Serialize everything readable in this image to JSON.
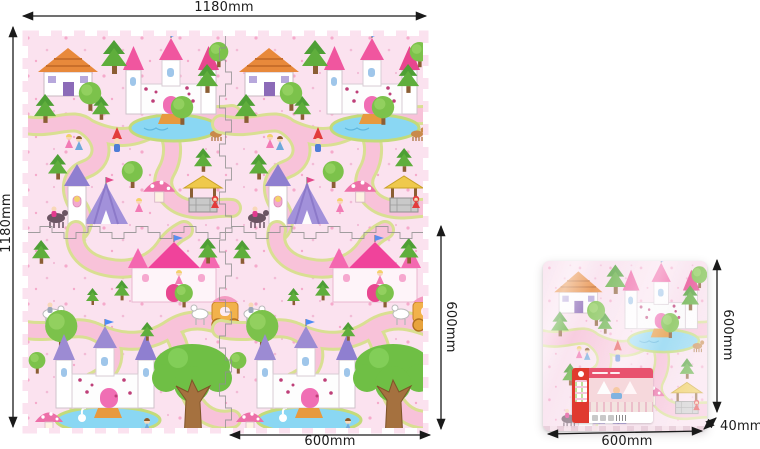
{
  "product": {
    "type_note": "princess castle foam puzzle play-mat dimension diagram"
  },
  "dimensions": {
    "mat_width": "1180mm",
    "mat_height": "1180mm",
    "tile_width": "600mm",
    "tile_height": "600mm",
    "package_width": "600mm",
    "package_height": "600mm",
    "package_thickness": "40mm"
  },
  "icons": {
    "dimension_arrow": "double-headed-black-arrow"
  },
  "colors": {
    "page_background": "#ffffff",
    "mat_background": "#FBE2EF",
    "road_fill": "#F8C2D9",
    "road_border": "#D9DF92",
    "pond_blue": "#8AD7F3",
    "tree_green": "#7CC24B",
    "pine_green": "#55A636",
    "castle_roof_pink": "#F0569F",
    "castle_roof_purple": "#9C8BD3",
    "house_roof_orange": "#E8893B",
    "trunk_brown": "#A5713F",
    "dimension_line": "#1a1a1a",
    "sticker_red": "#E03A2F"
  }
}
